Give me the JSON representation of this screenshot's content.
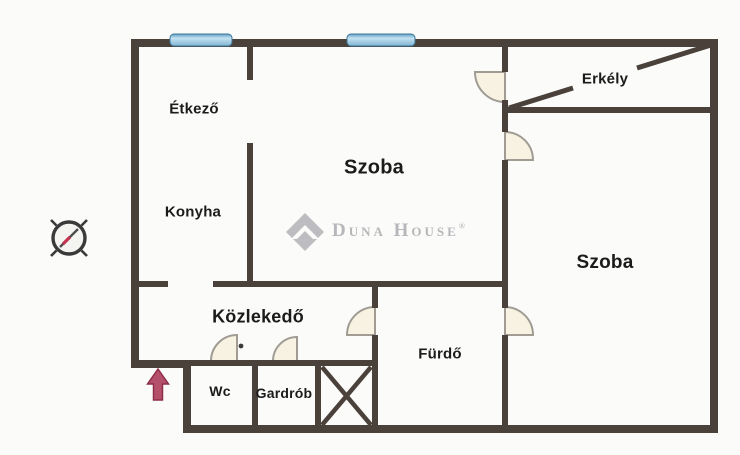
{
  "floorplan": {
    "rooms": {
      "etkezo": {
        "label": "Étkező"
      },
      "konyha": {
        "label": "Konyha"
      },
      "szoba_middle": {
        "label": "Szoba"
      },
      "erkely": {
        "label": "Erkély"
      },
      "szoba_right": {
        "label": "Szoba"
      },
      "kozlekedo": {
        "label": "Közlekedő"
      },
      "wc": {
        "label": "Wc"
      },
      "gardrob": {
        "label": "Gardrób"
      },
      "furdo": {
        "label": "Fürdő"
      }
    },
    "icons": {
      "compass": "compass-rose-icon",
      "entrance": "entrance-arrow-icon",
      "shaft": "crossed-box-shaft"
    },
    "colors": {
      "wall": "#4a413b",
      "window": "#8fc0dd",
      "door_leaf_fill": "#f8f2e3",
      "entrance_arrow": "#b5506b"
    }
  },
  "watermark": {
    "brand": "Duna House",
    "registered": "®"
  }
}
